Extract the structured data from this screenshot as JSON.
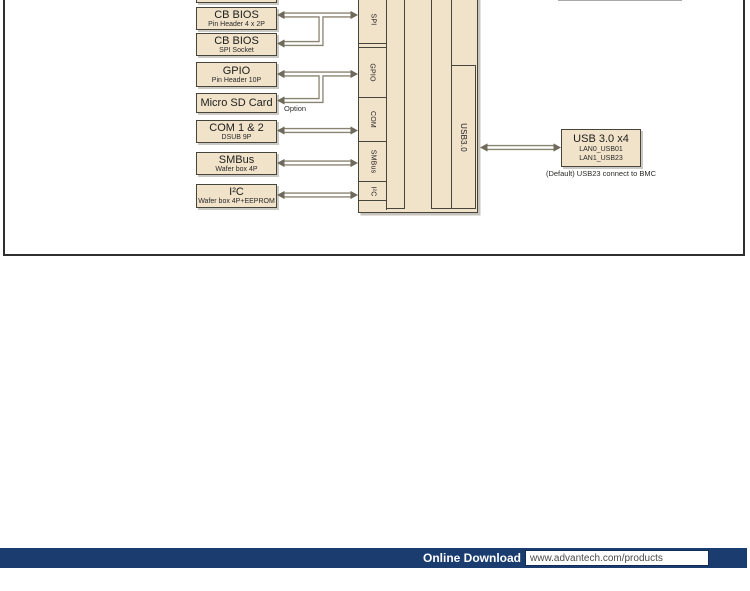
{
  "diagram": {
    "left_boxes": [
      {
        "title": "CB BIOS",
        "subtitle": "Pin Header 4 x 2P"
      },
      {
        "title": "CB BIOS",
        "subtitle": "SPI Socket"
      },
      {
        "title": "GPIO",
        "subtitle": "Pin Header 10P"
      },
      {
        "title": "Micro SD Card",
        "subtitle": ""
      },
      {
        "title": "COM 1 & 2",
        "subtitle": "DSUB 9P"
      },
      {
        "title": "SMBus",
        "subtitle": "Wafer box 4P"
      },
      {
        "title": "I²C",
        "subtitle": "Wafer box 4P+EEPROM"
      }
    ],
    "option_label": "Option",
    "ports": [
      "SPI",
      "GPIO",
      "COM",
      "SMBus",
      "I²C"
    ],
    "usb_column_label": "USB3.0",
    "right_box": {
      "title": "USB 3.0 x4",
      "lines": [
        "LAN0_USB01",
        "LAN1_USB23"
      ]
    },
    "right_box_caption": "(Default) USB23 connect to BMC"
  },
  "footer": {
    "label": "Online Download",
    "url": "www.advantech.com/products"
  },
  "colors": {
    "accent_navy": "#1a3c6e",
    "box_fill": "#f1e2ca",
    "box_border": "#47443b",
    "arrow": "#8a8372",
    "frame_border": "#2f2f2f"
  }
}
